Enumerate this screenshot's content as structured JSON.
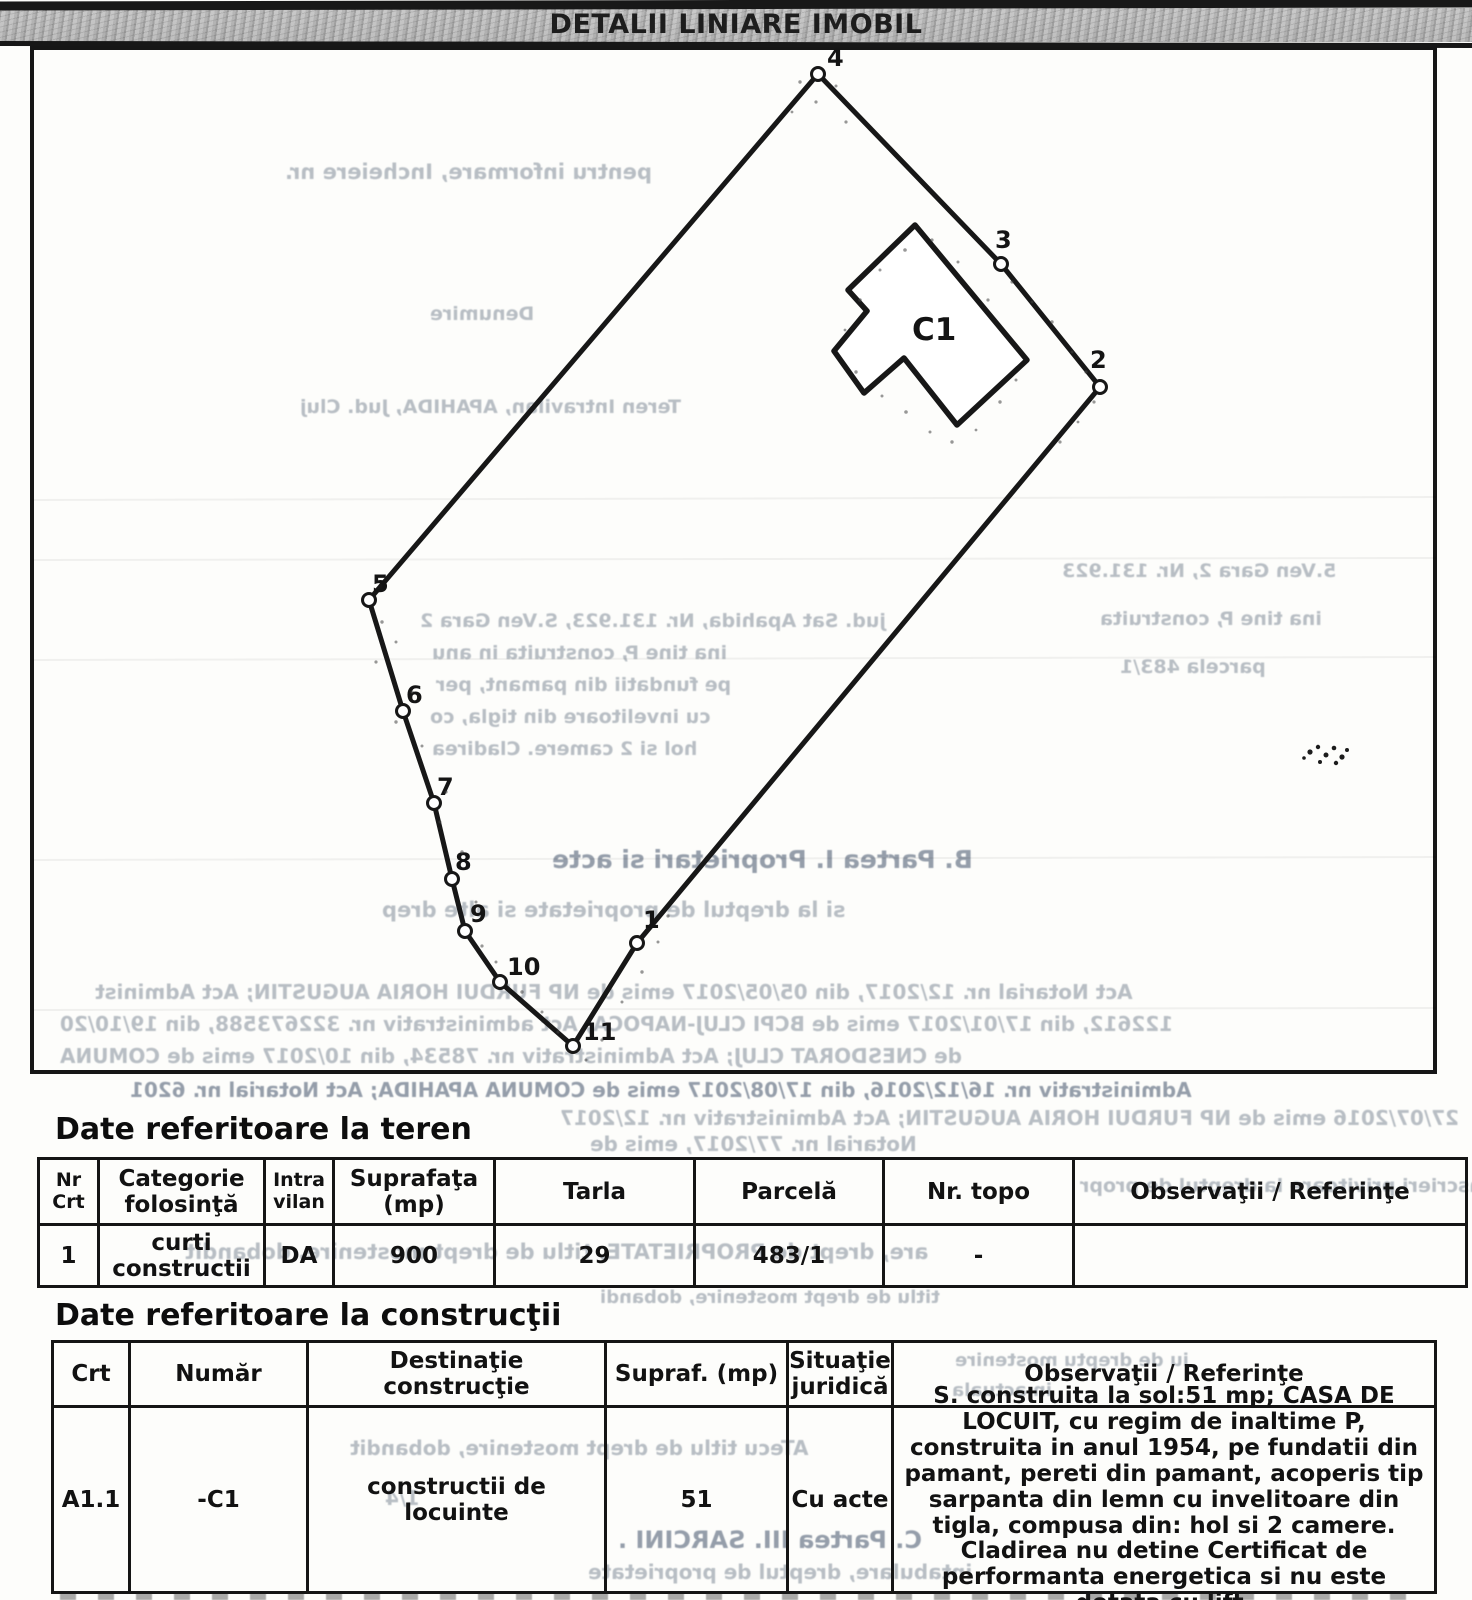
{
  "header": {
    "title": "DETALII LINIARE IMOBIL"
  },
  "diagram": {
    "building_label": "C1",
    "vertices": [
      "1",
      "2",
      "3",
      "4",
      "5",
      "6",
      "7",
      "8",
      "9",
      "10",
      "11"
    ]
  },
  "land_section": {
    "heading": "Date referitoare la teren",
    "table": {
      "headers": [
        "Nr\nCrt",
        "Categorie\nfolosinţă",
        "Intra\nvilan",
        "Suprafaţa\n(mp)",
        "Tarla",
        "Parcelă",
        "Nr. topo",
        "Observaţii / Referinţe"
      ],
      "row": [
        "1",
        "curti\nconstructii",
        "DA",
        "900",
        "29",
        "483/1",
        "-",
        ""
      ]
    }
  },
  "construction_section": {
    "heading": "Date referitoare la construcţii",
    "table": {
      "headers": [
        "Crt",
        "Număr",
        "Destinaţie\nconstrucţie",
        "Supraf. (mp)",
        "Situaţie\njuridică",
        "Observaţii / Referinţe"
      ],
      "row": [
        "A1.1",
        "-C1",
        "constructii de\nlocuinte",
        "51",
        "Cu acte",
        "S. construita la sol:51 mp;  CASA DE LOCUIT, cu regim de inaltime P, construita in anul 1954, pe fundatii din pamant, pereti din pamant, acoperis tip sarpanta din lemn cu invelitoare din tigla, compusa din: hol si 2 camere. Cladirea nu detine Certificat de performanta energetica si nu este dotata cu lift."
      ]
    }
  },
  "ghost_lines": [
    "pentru informare, Incheiere nr.",
    "Denumire",
    "Teren Intravilan, APAHIDA, Jud. Cluj",
    "jud. Sat Apahida, Nr. 131.923, S.Ven Gara 2",
    "ina tine P, construita in anu",
    "pe fundatii din pamant, per",
    "cu invelitoare din tigla, co",
    "hol si 2 camere. Cladirea",
    "5.Ven Gara 2, Nr. 131.923",
    "ina tine P, construita",
    "parcela 483/1",
    "B. Partea I. Proprietari si acte",
    "si la dreptul de proprietate si alte drep",
    "Act Notarial nr. 12/2017, din 05/05/2017 emis de NP FURDUI HORIA AUGUSTIN; Act Administ",
    "122612, din 17/01/2017 emis de BCPI CLUJ-NAPOCA; Act administrativ nr. 322673588, din 19/10/20",
    "de CNESDORAT CLUJ; Act Administrativ nr. 78534, din 10/2017 emis de COMUNA",
    "Administrativ nr. 16/12/2016, din 17/08/2017 emis de COMUNA APAHIDA; Act Notarial nr. 6201",
    "27/07/2016 emis de NP FURDUI HORIA AUGUSTIN; Act Administrativ nr. 12/2017",
    "Notarial nr. 77/2017, emis de",
    "Inscrieri privitoare la dreptul de propr",
    "are, drept de PROPRIETATE, titlu de drept mostenire, dobandit",
    "titlu de drept mostenire, dobandi",
    "iu de dreptu mostenire",
    "in actuala",
    "ATecu titlu de drept mostenire, dobandit",
    "1/4",
    "C. Partea III. SARCINI .",
    "intabulare, dreptul de proprietate"
  ]
}
